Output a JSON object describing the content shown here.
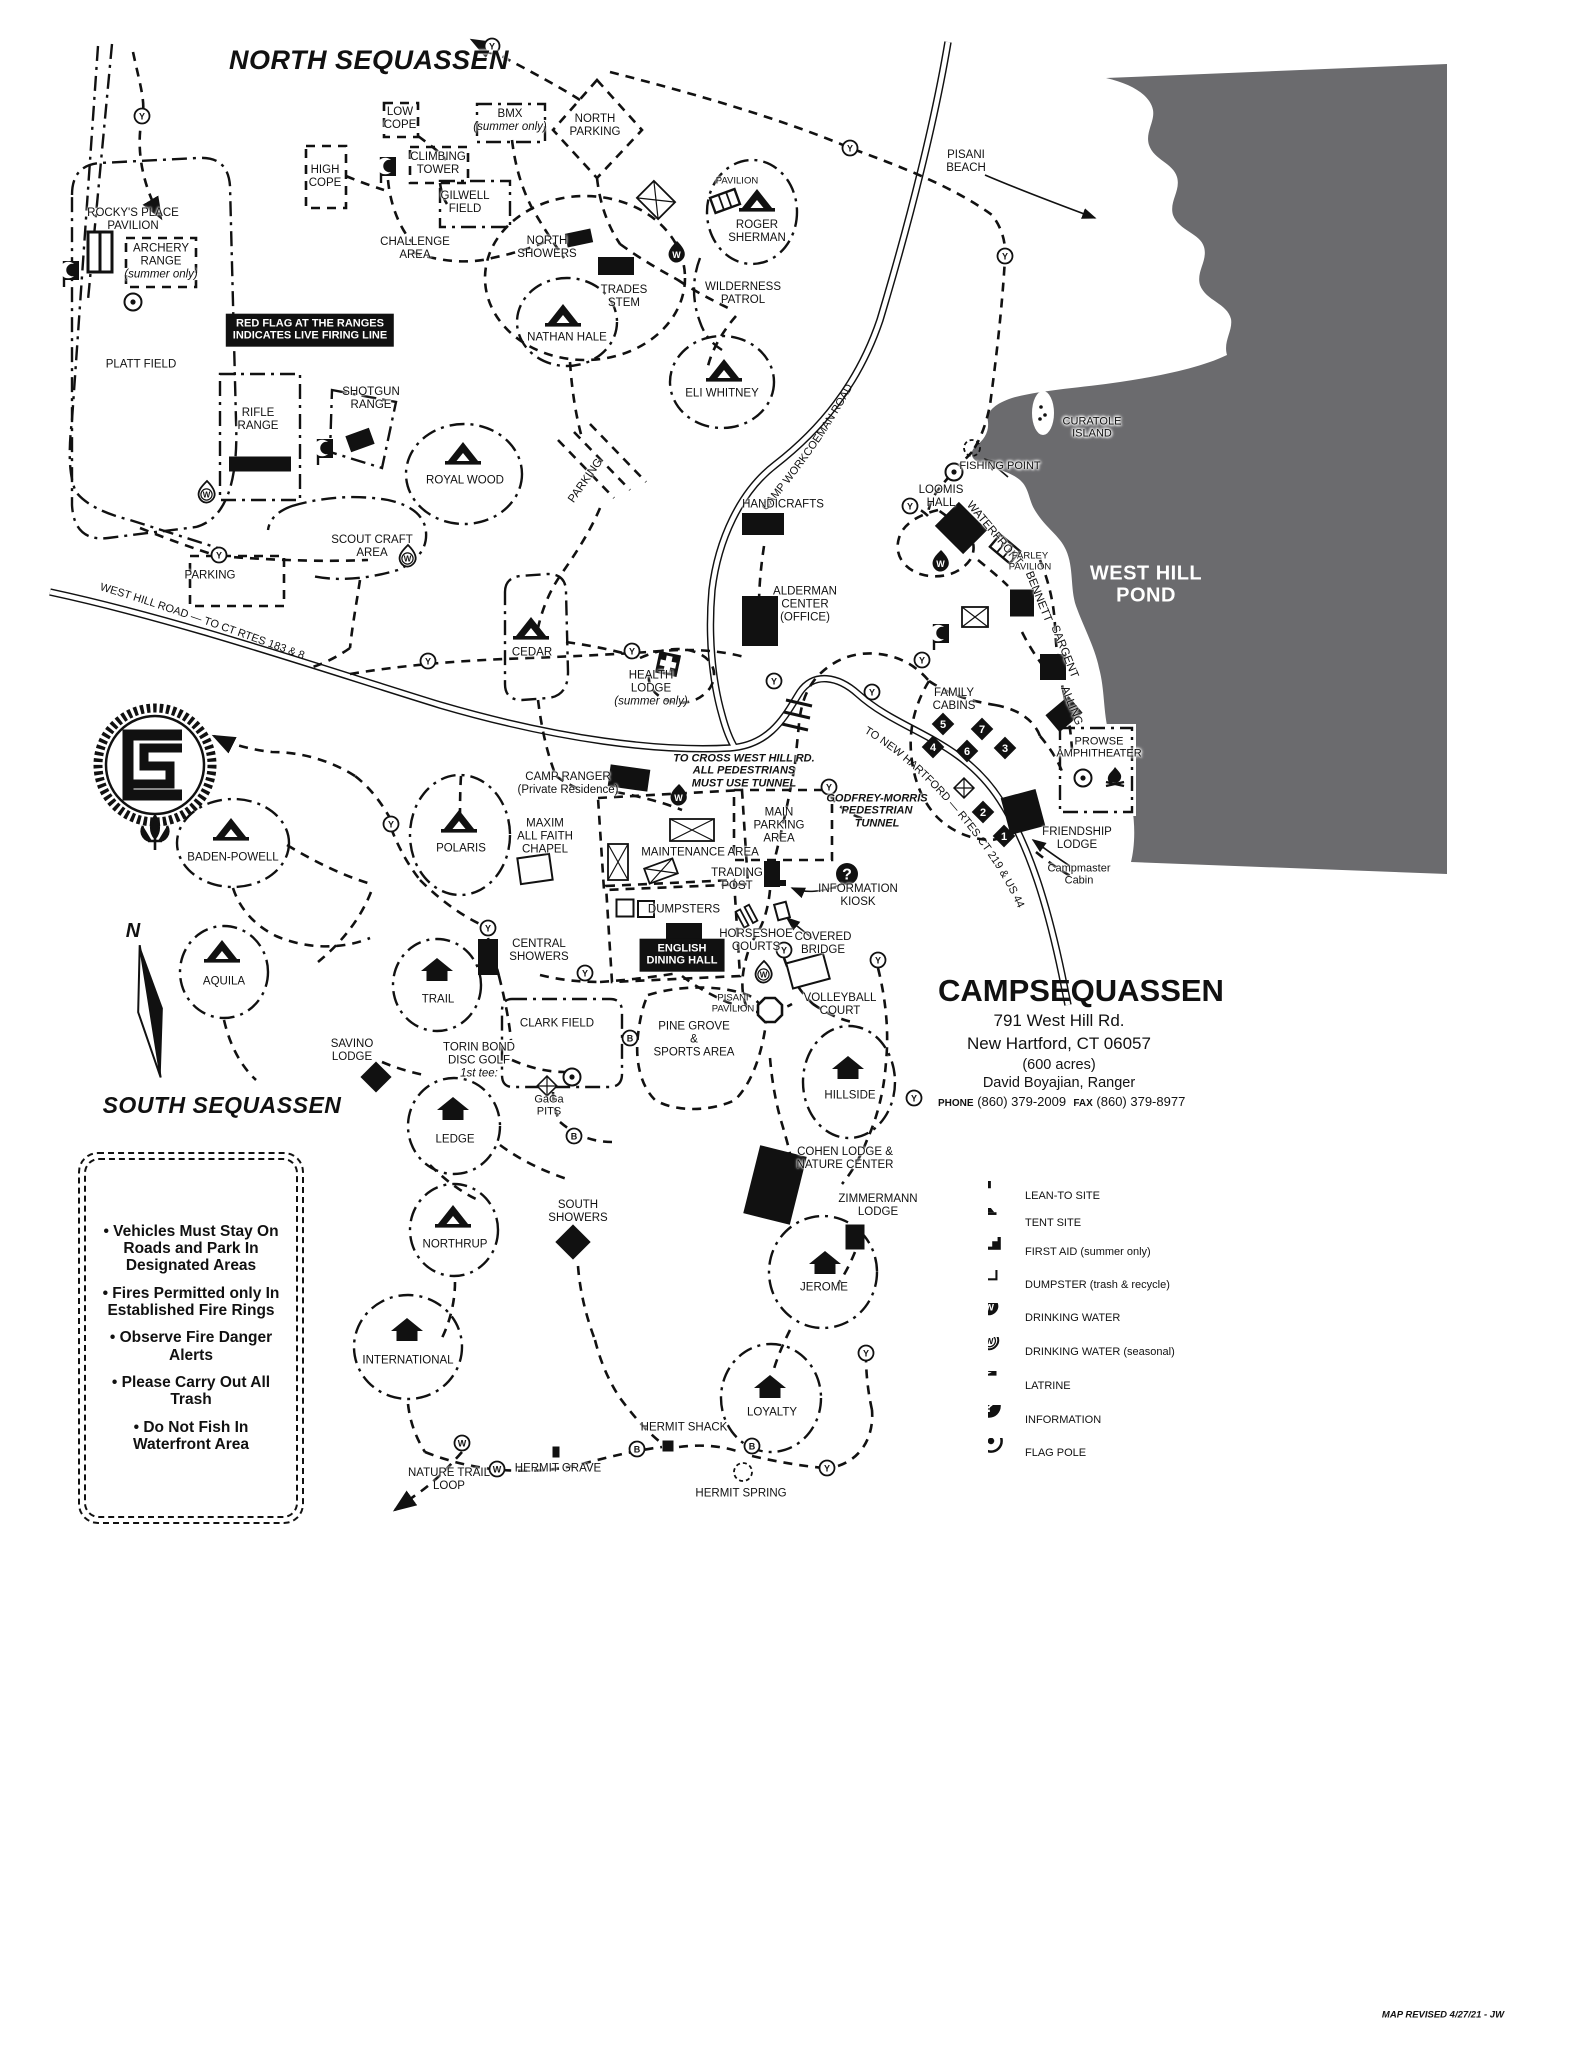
{
  "map": {
    "roads": {
      "west_hill": "WEST HILL ROAD — TO CT RTES 183 & 8",
      "workcoeman": "CAMP WORKCOEMAN ROAD",
      "new_hartford": "TO NEW HARTFORD — RTES CT 219 & US 44"
    },
    "labels": [
      {
        "t": "NORTH SEQUASSEN",
        "x": 369,
        "y": 60,
        "c": "title"
      },
      {
        "t": "SOUTH  SEQUASSEN",
        "x": 222,
        "y": 1106,
        "c": "title2"
      },
      {
        "t": "ROCKY'S PLACE\nPAVILION",
        "x": 133,
        "y": 220
      },
      {
        "t": "ARCHERY\nRANGE\n(summer only)",
        "x": 161,
        "y": 262,
        "it": 2
      },
      {
        "t": "PLATT FIELD",
        "x": 141,
        "y": 365
      },
      {
        "t": "RIFLE\nRANGE",
        "x": 258,
        "y": 420
      },
      {
        "t": "SHOTGUN\nRANGE",
        "x": 371,
        "y": 399
      },
      {
        "t": "LOW\nCOPE",
        "x": 400,
        "y": 119
      },
      {
        "t": "HIGH\nCOPE",
        "x": 325,
        "y": 177
      },
      {
        "t": "CLIMBING\nTOWER",
        "x": 438,
        "y": 164
      },
      {
        "t": "GILWELL\nFIELD",
        "x": 465,
        "y": 203
      },
      {
        "t": "BMX\n(summer only)",
        "x": 510,
        "y": 121,
        "it": 1
      },
      {
        "t": "NORTH\nPARKING",
        "x": 595,
        "y": 126
      },
      {
        "t": "CHALLENGE\nAREA",
        "x": 415,
        "y": 249
      },
      {
        "t": "NORTH\nSHOWERS",
        "x": 547,
        "y": 248
      },
      {
        "t": "TRADES\nSTEM",
        "x": 624,
        "y": 297
      },
      {
        "t": "NATHAN HALE",
        "x": 567,
        "y": 338
      },
      {
        "t": "PAVILION",
        "x": 737,
        "y": 182,
        "c": "sm"
      },
      {
        "t": "ROGER\nSHERMAN",
        "x": 757,
        "y": 232
      },
      {
        "t": "WILDERNESS\nPATROL",
        "x": 743,
        "y": 294
      },
      {
        "t": "ELI WHITNEY",
        "x": 722,
        "y": 394
      },
      {
        "t": "PISANI\nBEACH",
        "x": 966,
        "y": 162
      },
      {
        "t": "CURATOLE\nISLAND",
        "x": 1092,
        "y": 428,
        "c": "halo"
      },
      {
        "t": "FISHING POINT",
        "x": 1000,
        "y": 466,
        "c": "halo"
      },
      {
        "t": "WEST HILL\nPOND",
        "x": 1146,
        "y": 585,
        "c": "pond"
      },
      {
        "t": "LOOMIS\nHALL",
        "x": 941,
        "y": 497
      },
      {
        "t": "WATERFRONT",
        "x": 994,
        "y": 534,
        "r": 50
      },
      {
        "t": "FARLEY\nPAVILION",
        "x": 1030,
        "y": 562,
        "c": "sm"
      },
      {
        "t": "BENNETT",
        "x": 1038,
        "y": 597,
        "r": 68
      },
      {
        "t": "SARGENT",
        "x": 1064,
        "y": 652,
        "r": 68
      },
      {
        "t": "ALLING",
        "x": 1071,
        "y": 706,
        "r": 68
      },
      {
        "t": "ROYAL WOOD",
        "x": 465,
        "y": 481
      },
      {
        "t": "PARKING",
        "x": 586,
        "y": 481,
        "r": -55
      },
      {
        "t": "PARKING",
        "x": 210,
        "y": 576
      },
      {
        "t": "SCOUT CRAFT\nAREA",
        "x": 372,
        "y": 547
      },
      {
        "t": "HANDICRAFTS",
        "x": 783,
        "y": 505
      },
      {
        "t": "ALDERMAN\nCENTER\n(OFFICE)",
        "x": 805,
        "y": 605
      },
      {
        "t": "CEDAR",
        "x": 532,
        "y": 653
      },
      {
        "t": "HEALTH\nLODGE\n(summer only)",
        "x": 651,
        "y": 689,
        "it": 2
      },
      {
        "t": "CAMP RANGER\n(Private Residence)",
        "x": 568,
        "y": 784
      },
      {
        "t": "FAMILY\nCABINS",
        "x": 954,
        "y": 700
      },
      {
        "t": "PROWSE\nAMPHITHEATER",
        "x": 1099,
        "y": 748,
        "c": "halo"
      },
      {
        "t": "FRIENDSHIP\nLODGE",
        "x": 1077,
        "y": 839
      },
      {
        "t": "Campmaster\nCabin",
        "x": 1079,
        "y": 875,
        "c": "mc"
      },
      {
        "t": "TO CROSS WEST HILL RD.\nALL PEDESTRIANS\nMUST USE TUNNEL",
        "x": 744,
        "y": 771,
        "c": "warn"
      },
      {
        "t": "GODFREY-MORRIS\nPEDESTRIAN\nTUNNEL",
        "x": 877,
        "y": 811,
        "c": "warn"
      },
      {
        "t": "MAIN\nPARKING\nAREA",
        "x": 779,
        "y": 826
      },
      {
        "t": "MAXIM\nALL FAITH\nCHAPEL",
        "x": 545,
        "y": 837
      },
      {
        "t": "MAINTENANCE AREA",
        "x": 700,
        "y": 853
      },
      {
        "t": "TRADING\nPOST",
        "x": 737,
        "y": 880
      },
      {
        "t": "DUMPSTERS",
        "x": 684,
        "y": 910
      },
      {
        "t": "INFORMATION\nKIOSK",
        "x": 858,
        "y": 896
      },
      {
        "t": "HORSESHOE\nCOURTS",
        "x": 756,
        "y": 941
      },
      {
        "t": "COVERED\nBRIDGE",
        "x": 823,
        "y": 944
      },
      {
        "t": "VOLLEYBALL\nCOURT",
        "x": 840,
        "y": 1005
      },
      {
        "t": "PISANI\nPAVILION",
        "x": 733,
        "y": 1004,
        "c": "sm"
      },
      {
        "t": "ENGLISH\nDINING HALL",
        "x": 682,
        "y": 955,
        "c": "banner"
      },
      {
        "t": "CENTRAL\nSHOWERS",
        "x": 539,
        "y": 951
      },
      {
        "t": "POLARIS",
        "x": 461,
        "y": 849
      },
      {
        "t": "BADEN-POWELL",
        "x": 233,
        "y": 858
      },
      {
        "t": "AQUILA",
        "x": 224,
        "y": 982
      },
      {
        "t": "TRAIL",
        "x": 438,
        "y": 1000
      },
      {
        "t": "CLARK FIELD",
        "x": 557,
        "y": 1024
      },
      {
        "t": "PINE GROVE\n&\nSPORTS AREA",
        "x": 694,
        "y": 1040
      },
      {
        "t": "HILLSIDE",
        "x": 850,
        "y": 1096
      },
      {
        "t": "SAVINO\nLODGE",
        "x": 352,
        "y": 1051
      },
      {
        "t": "TORIN BOND\nDISC GOLF\n1st tee:",
        "x": 479,
        "y": 1061,
        "it": 2
      },
      {
        "t": "GaGa\nPITS",
        "x": 549,
        "y": 1106,
        "c": "mc"
      },
      {
        "t": "LEDGE",
        "x": 455,
        "y": 1140
      },
      {
        "t": "NORTHRUP",
        "x": 455,
        "y": 1245
      },
      {
        "t": "COHEN  LODGE &\nNATURE CENTER",
        "x": 845,
        "y": 1159
      },
      {
        "t": "ZIMMERMANN\nLODGE",
        "x": 878,
        "y": 1206
      },
      {
        "t": "JEROME",
        "x": 824,
        "y": 1288
      },
      {
        "t": "SOUTH\nSHOWERS",
        "x": 578,
        "y": 1212
      },
      {
        "t": "INTERNATIONAL",
        "x": 408,
        "y": 1361
      },
      {
        "t": "LOYALTY",
        "x": 772,
        "y": 1413
      },
      {
        "t": "HERMIT SHACK",
        "x": 684,
        "y": 1428
      },
      {
        "t": "HERMIT GRAVE",
        "x": 558,
        "y": 1469
      },
      {
        "t": "NATURE TRAIL\nLOOP",
        "x": 449,
        "y": 1480
      },
      {
        "t": "HERMIT SPRING",
        "x": 741,
        "y": 1494
      },
      {
        "t": "RED FLAG AT THE RANGES\nINDICATES LIVE FIRING LINE",
        "x": 310,
        "y": 330,
        "c": "banner"
      },
      {
        "t": "MAP REVISED 4/27/21 - JW",
        "x": 1443,
        "y": 2016,
        "c": "rev"
      },
      {
        "t": "N",
        "x": 133,
        "y": 931,
        "c": "north"
      }
    ],
    "icons": [
      {
        "k": "tent",
        "x": 563,
        "y": 316
      },
      {
        "k": "tent",
        "x": 757,
        "y": 201
      },
      {
        "k": "tent",
        "x": 724,
        "y": 371
      },
      {
        "k": "tent",
        "x": 463,
        "y": 454
      },
      {
        "k": "tent",
        "x": 531,
        "y": 629
      },
      {
        "k": "tent",
        "x": 459,
        "y": 822
      },
      {
        "k": "tent",
        "x": 231,
        "y": 830
      },
      {
        "k": "tent",
        "x": 222,
        "y": 952
      },
      {
        "k": "tent",
        "x": 453,
        "y": 1217
      },
      {
        "k": "leanto",
        "x": 437,
        "y": 970
      },
      {
        "k": "leanto",
        "x": 848,
        "y": 1068
      },
      {
        "k": "leanto",
        "x": 453,
        "y": 1109
      },
      {
        "k": "leanto",
        "x": 407,
        "y": 1330
      },
      {
        "k": "leanto",
        "x": 825,
        "y": 1263
      },
      {
        "k": "leanto",
        "x": 770,
        "y": 1387
      },
      {
        "k": "bldg",
        "x": 579,
        "y": 238,
        "w": 26,
        "h": 14,
        "r": -12
      },
      {
        "k": "bldg",
        "x": 616,
        "y": 266,
        "w": 36,
        "h": 18
      },
      {
        "k": "bldg",
        "x": 260,
        "y": 464,
        "w": 62,
        "h": 15
      },
      {
        "k": "bldg",
        "x": 360,
        "y": 440,
        "w": 25,
        "h": 17,
        "r": -20
      },
      {
        "k": "bldg",
        "x": 763,
        "y": 524,
        "w": 42,
        "h": 22
      },
      {
        "k": "bldg",
        "x": 961,
        "y": 528,
        "w": 40,
        "h": 34,
        "r": 45
      },
      {
        "k": "bldg",
        "x": 760,
        "y": 621,
        "w": 36,
        "h": 50
      },
      {
        "k": "bldg",
        "x": 1022,
        "y": 603,
        "w": 24,
        "h": 27
      },
      {
        "k": "bldg",
        "x": 1053,
        "y": 667,
        "w": 26,
        "h": 26
      },
      {
        "k": "bldg",
        "x": 1064,
        "y": 714,
        "w": 30,
        "h": 22,
        "r": -40
      },
      {
        "k": "bldg",
        "x": 1023,
        "y": 812,
        "w": 36,
        "h": 38,
        "r": -15
      },
      {
        "k": "bldg",
        "x": 629,
        "y": 778,
        "w": 40,
        "h": 22,
        "r": 8
      },
      {
        "k": "bldg",
        "x": 772,
        "y": 874,
        "w": 16,
        "h": 26
      },
      {
        "k": "bldg",
        "x": 488,
        "y": 957,
        "w": 20,
        "h": 36
      },
      {
        "k": "bldg",
        "x": 684,
        "y": 931,
        "w": 36,
        "h": 16
      },
      {
        "k": "bldg",
        "x": 775,
        "y": 1185,
        "w": 48,
        "h": 70,
        "r": 14
      },
      {
        "k": "bldg",
        "x": 855,
        "y": 1237,
        "w": 19,
        "h": 25
      },
      {
        "k": "bldg",
        "x": 376,
        "y": 1077,
        "w": 22,
        "h": 22,
        "r": 45
      },
      {
        "k": "bldg",
        "x": 573,
        "y": 1242,
        "w": 25,
        "h": 25,
        "r": 45
      },
      {
        "k": "bldg",
        "x": 668,
        "y": 1446,
        "w": 11,
        "h": 11
      },
      {
        "k": "bldg",
        "x": 556,
        "y": 1452,
        "w": 7,
        "h": 11
      },
      {
        "k": "bldg",
        "x": 779,
        "y": 883,
        "w": 14,
        "h": 6
      },
      {
        "k": "pav2",
        "x": 100,
        "y": 252
      },
      {
        "k": "stripe",
        "x": 725,
        "y": 201,
        "r": -20
      },
      {
        "k": "stripe",
        "x": 1005,
        "y": 549,
        "r": 40
      },
      {
        "k": "latrine",
        "x": 71,
        "y": 274
      },
      {
        "k": "latrine",
        "x": 388,
        "y": 170
      },
      {
        "k": "latrine",
        "x": 325,
        "y": 452
      },
      {
        "k": "latrine",
        "x": 941,
        "y": 637
      },
      {
        "k": "firstaid",
        "x": 668,
        "y": 664,
        "r": 12
      },
      {
        "k": "waterB",
        "x": 677,
        "y": 252
      },
      {
        "k": "waterB",
        "x": 679,
        "y": 795
      },
      {
        "k": "waterB",
        "x": 941,
        "y": 561
      },
      {
        "k": "waterS",
        "x": 207,
        "y": 492
      },
      {
        "k": "waterS",
        "x": 408,
        "y": 556
      },
      {
        "k": "waterS",
        "x": 764,
        "y": 972
      },
      {
        "k": "flag",
        "x": 133,
        "y": 302
      },
      {
        "k": "flag",
        "x": 954,
        "y": 472
      },
      {
        "k": "flag",
        "x": 1083,
        "y": 778
      },
      {
        "k": "flag",
        "x": 572,
        "y": 1077
      },
      {
        "k": "info",
        "x": 847,
        "y": 874
      },
      {
        "k": "xbox",
        "x": 656,
        "y": 200,
        "w": 30,
        "h": 24,
        "r": 45
      },
      {
        "k": "xbox",
        "x": 975,
        "y": 617,
        "w": 26,
        "h": 20
      },
      {
        "k": "xbox",
        "x": 692,
        "y": 830,
        "w": 44,
        "h": 22
      },
      {
        "k": "xbox",
        "x": 618,
        "y": 862,
        "w": 20,
        "h": 36
      },
      {
        "k": "xbox",
        "x": 661,
        "y": 871,
        "w": 30,
        "h": 16,
        "r": -20
      },
      {
        "k": "xdiam",
        "x": 964,
        "y": 788
      },
      {
        "k": "xdiam",
        "x": 547,
        "y": 1086
      },
      {
        "k": "wrect",
        "x": 535,
        "y": 869,
        "w": 32,
        "h": 26,
        "r": -8
      },
      {
        "k": "wrect",
        "x": 808,
        "y": 971,
        "w": 38,
        "h": 26,
        "r": -15
      },
      {
        "k": "wrect",
        "x": 782,
        "y": 911,
        "w": 12,
        "h": 16,
        "r": -15
      },
      {
        "k": "wrect",
        "x": 625,
        "y": 908,
        "w": 17,
        "h": 17
      },
      {
        "k": "wrect",
        "x": 646,
        "y": 909,
        "w": 16,
        "h": 16
      },
      {
        "k": "hs",
        "x": 747,
        "y": 916,
        "r": -28
      },
      {
        "k": "oct",
        "x": 770,
        "y": 1010
      },
      {
        "k": "fire",
        "x": 1115,
        "y": 778
      },
      {
        "k": "island",
        "x": 1043,
        "y": 413
      },
      {
        "k": "dcirc",
        "x": 972,
        "y": 448,
        "rad": 8
      },
      {
        "k": "dcirc",
        "x": 743,
        "y": 1472,
        "rad": 9
      }
    ],
    "cabins": [
      {
        "n": "1",
        "x": 1004,
        "y": 836
      },
      {
        "n": "2",
        "x": 983,
        "y": 812
      },
      {
        "n": "3",
        "x": 1005,
        "y": 748
      },
      {
        "n": "4",
        "x": 933,
        "y": 747
      },
      {
        "n": "5",
        "x": 943,
        "y": 724
      },
      {
        "n": "6",
        "x": 967,
        "y": 751
      },
      {
        "n": "7",
        "x": 982,
        "y": 729
      }
    ],
    "markers": [
      {
        "l": "Y",
        "x": 142,
        "y": 116
      },
      {
        "l": "Y",
        "x": 492,
        "y": 46
      },
      {
        "l": "Y",
        "x": 850,
        "y": 148
      },
      {
        "l": "Y",
        "x": 1005,
        "y": 256
      },
      {
        "l": "Y",
        "x": 219,
        "y": 555
      },
      {
        "l": "Y",
        "x": 428,
        "y": 661
      },
      {
        "l": "Y",
        "x": 632,
        "y": 651
      },
      {
        "l": "Y",
        "x": 910,
        "y": 506
      },
      {
        "l": "Y",
        "x": 922,
        "y": 660
      },
      {
        "l": "Y",
        "x": 774,
        "y": 681
      },
      {
        "l": "Y",
        "x": 872,
        "y": 692
      },
      {
        "l": "Y",
        "x": 829,
        "y": 787
      },
      {
        "l": "Y",
        "x": 391,
        "y": 824
      },
      {
        "l": "Y",
        "x": 488,
        "y": 928
      },
      {
        "l": "Y",
        "x": 585,
        "y": 973
      },
      {
        "l": "Y",
        "x": 784,
        "y": 950
      },
      {
        "l": "Y",
        "x": 878,
        "y": 960
      },
      {
        "l": "Y",
        "x": 914,
        "y": 1098
      },
      {
        "l": "Y",
        "x": 866,
        "y": 1353
      },
      {
        "l": "Y",
        "x": 827,
        "y": 1468
      },
      {
        "l": "B",
        "x": 630,
        "y": 1038
      },
      {
        "l": "B",
        "x": 574,
        "y": 1136
      },
      {
        "l": "B",
        "x": 637,
        "y": 1449
      },
      {
        "l": "B",
        "x": 752,
        "y": 1446
      },
      {
        "l": "W",
        "x": 462,
        "y": 1443
      },
      {
        "l": "W",
        "x": 497,
        "y": 1469
      }
    ]
  },
  "info": {
    "name1": "CAMP",
    "name2": "SEQUASSEN",
    "address1": "791 West Hill Rd.",
    "address2": "New Hartford, CT 06057",
    "acres": "(600 acres)",
    "ranger": "David Boyajian, Ranger",
    "phone_label": "PHONE",
    "phone": "(860) 379-2009",
    "fax_label": "FAX",
    "fax": "(860) 379-8977"
  },
  "legend": {
    "items": [
      {
        "icon": "leanto",
        "label": "LEAN-TO SITE"
      },
      {
        "icon": "tent",
        "label": "TENT SITE"
      },
      {
        "icon": "firstaid",
        "label": "FIRST AID (summer only)"
      },
      {
        "icon": "dumpster",
        "label": "DUMPSTER (trash & recycle)"
      },
      {
        "icon": "waterB",
        "label": "DRINKING WATER"
      },
      {
        "icon": "waterS",
        "label": "DRINKING WATER (seasonal)"
      },
      {
        "icon": "latrine",
        "label": "LATRINE"
      },
      {
        "icon": "info",
        "label": "INFORMATION"
      },
      {
        "icon": "flag",
        "label": "FLAG POLE"
      }
    ]
  },
  "rules": [
    "Vehicles Must Stay On Roads and Park In Designated Areas",
    "Fires Permitted only In Established Fire Rings",
    "Observe Fire Danger Alerts",
    "Please Carry Out All Trash",
    "Do Not Fish In Waterfront Area"
  ]
}
